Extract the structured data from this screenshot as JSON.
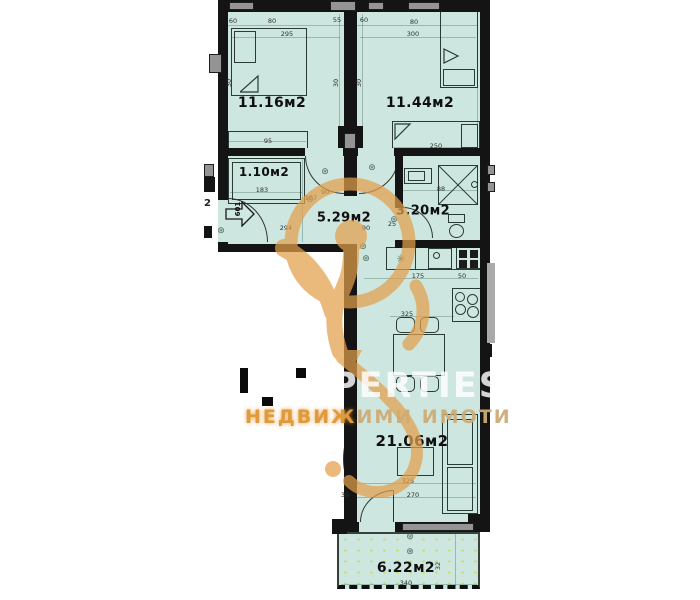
{
  "colors": {
    "floor_fill": "#cde7e0",
    "terrace_dot": "#c6dd74",
    "wall": "#141414",
    "window_gray": "#949494",
    "watermark_orange": "#e3a04b"
  },
  "watermark": {
    "brand_visible_text": "PERTIES",
    "subtitle_left": "НЕДВИЖ",
    "subtitle_right": "ИМИ ИМОТИ"
  },
  "plan": {
    "entrance_number": "601",
    "adjacent_area_fragment": "2",
    "fixture_symbol": "⊛",
    "fridge_symbol": "✳",
    "rooms": [
      {
        "label": "11.16м2",
        "x": 272,
        "y": 103,
        "fs": 14
      },
      {
        "label": "11.44м2",
        "x": 420,
        "y": 103,
        "fs": 14
      },
      {
        "label": "1.10м2",
        "x": 264,
        "y": 172,
        "fs": 12
      },
      {
        "label": "5.29м2",
        "x": 344,
        "y": 218,
        "fs": 13
      },
      {
        "label": "3.20м2",
        "x": 423,
        "y": 211,
        "fs": 13
      },
      {
        "label": "21.06м2",
        "x": 412,
        "y": 441,
        "fs": 15
      },
      {
        "label": "6.22м2",
        "x": 406,
        "y": 568,
        "fs": 14
      }
    ],
    "dimensions": [
      {
        "t": "60",
        "x": 233,
        "y": 21
      },
      {
        "t": "80",
        "x": 272,
        "y": 21
      },
      {
        "t": "295",
        "x": 287,
        "y": 34
      },
      {
        "t": "55",
        "x": 337,
        "y": 20
      },
      {
        "t": "60",
        "x": 364,
        "y": 20
      },
      {
        "t": "80",
        "x": 414,
        "y": 22
      },
      {
        "t": "300",
        "x": 413,
        "y": 34
      },
      {
        "t": "30",
        "x": 229,
        "y": 83,
        "r": 1
      },
      {
        "t": "30",
        "x": 336,
        "y": 83,
        "r": 1
      },
      {
        "t": "30",
        "x": 359,
        "y": 83,
        "r": 1
      },
      {
        "t": "95",
        "x": 268,
        "y": 141
      },
      {
        "t": "250",
        "x": 436,
        "y": 146
      },
      {
        "t": "183",
        "x": 262,
        "y": 190
      },
      {
        "t": "88",
        "x": 441,
        "y": 189
      },
      {
        "t": "90",
        "x": 325,
        "y": 192
      },
      {
        "t": "107",
        "x": 311,
        "y": 198
      },
      {
        "t": "294",
        "x": 286,
        "y": 228
      },
      {
        "t": "90",
        "x": 366,
        "y": 228
      },
      {
        "t": "25",
        "x": 392,
        "y": 224
      },
      {
        "t": "175",
        "x": 418,
        "y": 276
      },
      {
        "t": "50",
        "x": 462,
        "y": 276
      },
      {
        "t": "325",
        "x": 407,
        "y": 314
      },
      {
        "t": "325",
        "x": 408,
        "y": 481
      },
      {
        "t": "270",
        "x": 413,
        "y": 495
      },
      {
        "t": "39",
        "x": 345,
        "y": 495
      },
      {
        "t": "340",
        "x": 406,
        "y": 583
      },
      {
        "t": "32",
        "x": 438,
        "y": 566,
        "r": 1
      }
    ],
    "fixtures": [
      {
        "x": 325,
        "y": 172
      },
      {
        "x": 372,
        "y": 168
      },
      {
        "x": 310,
        "y": 200
      },
      {
        "x": 363,
        "y": 247
      },
      {
        "x": 366,
        "y": 259
      },
      {
        "x": 394,
        "y": 220
      },
      {
        "x": 221,
        "y": 231
      },
      {
        "x": 410,
        "y": 537
      },
      {
        "x": 410,
        "y": 552
      }
    ],
    "guides": [
      {
        "x": 228,
        "y": 25,
        "w": 250,
        "h": 1
      },
      {
        "x": 232,
        "y": 37,
        "w": 108,
        "h": 1
      },
      {
        "x": 360,
        "y": 37,
        "w": 116,
        "h": 1
      },
      {
        "x": 228,
        "y": 141,
        "w": 78,
        "h": 1
      },
      {
        "x": 392,
        "y": 147,
        "w": 86,
        "h": 1
      },
      {
        "x": 230,
        "y": 192,
        "w": 72,
        "h": 1
      },
      {
        "x": 400,
        "y": 190,
        "w": 78,
        "h": 1
      },
      {
        "x": 364,
        "y": 278,
        "w": 114,
        "h": 1
      },
      {
        "x": 390,
        "y": 316,
        "w": 64,
        "h": 1
      },
      {
        "x": 350,
        "y": 483,
        "w": 126,
        "h": 1
      },
      {
        "x": 350,
        "y": 497,
        "w": 126,
        "h": 1
      },
      {
        "x": 341,
        "y": 584,
        "w": 136,
        "h": 1
      },
      {
        "x": 225,
        "y": 14,
        "w": 1,
        "h": 132
      },
      {
        "x": 339,
        "y": 14,
        "w": 1,
        "h": 132
      },
      {
        "x": 362,
        "y": 14,
        "w": 1,
        "h": 132
      },
      {
        "x": 477,
        "y": 14,
        "w": 1,
        "h": 132
      },
      {
        "x": 455,
        "y": 534,
        "w": 1,
        "h": 52
      },
      {
        "x": 302,
        "y": 158,
        "w": 1,
        "h": 84
      }
    ]
  }
}
